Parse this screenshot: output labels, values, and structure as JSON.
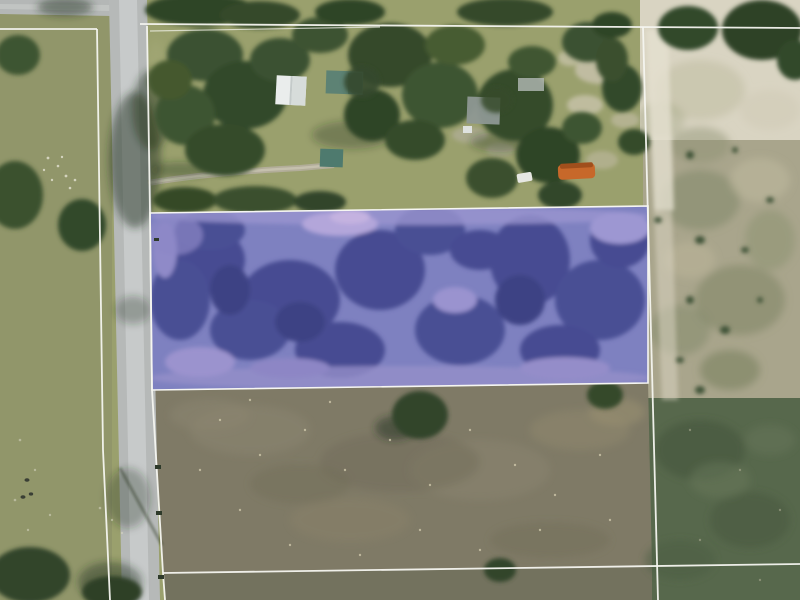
{
  "map": {
    "view": "aerial-parcel-view",
    "colors": {
      "pasture": "#91966a",
      "grass": "#9aa06d",
      "road": "#b6b9b8",
      "road_center": "#cacdcc",
      "dirt_field": "#7f7a66",
      "dirt_field_lower": "#73725e",
      "scrub": "#a9a58c",
      "sand": "#d9d4c2",
      "dark_green_field": "#57684c",
      "tree_dark": "#344827",
      "boundary_line": "#f5f5f0",
      "parcel_overlay": "#7e81c0",
      "parcel_overlay_dark": "#474c92",
      "parcel_outline": "#f6f6f2",
      "driveway": "#b3ae9c",
      "shadow": "#22321f"
    },
    "features": {
      "highlighted_parcel": {
        "status": "selected",
        "fill": "#7e81c0",
        "outline": "#f6f6f2"
      },
      "white_roof_building": {
        "fill": "#eaedec"
      },
      "teal_roof_house": {
        "fill": "#5d8274"
      },
      "teal_roof_shed": {
        "fill": "#4e7a6e"
      },
      "gray_roof_house": {
        "fill": "#8e9894"
      },
      "gray_roof_small": {
        "fill": "#b4bab6"
      },
      "orange_trailer": {
        "fill": "#c7682a"
      },
      "white_car": {
        "fill": "#e6e7e2"
      }
    }
  }
}
